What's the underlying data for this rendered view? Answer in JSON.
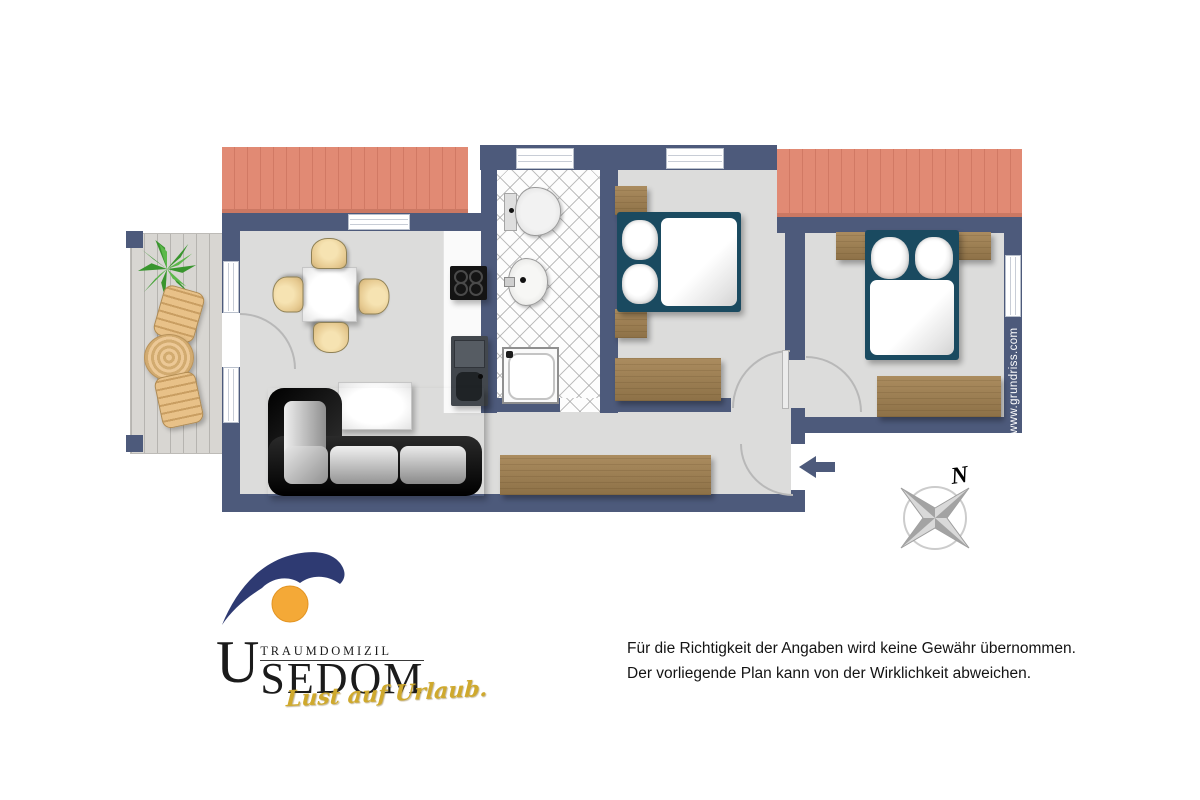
{
  "plan": {
    "watermark": "www.grundriss.com",
    "compass_label": "N"
  },
  "logo": {
    "brand_top": "TRAUMDOMIZIL",
    "brand_initial": "U",
    "brand_rest": "SEDOM",
    "tagline": "Lust auf Urlaub."
  },
  "disclaimer": {
    "line1": "Für die Richtigkeit der Angaben wird keine Gewähr übernommen.",
    "line2": "Der vorliegende Plan kann von der Wirklichkeit abweichen."
  },
  "colors": {
    "wall": "#4d5a7b",
    "roof": "#e18a74",
    "floor": "#dcdcdb",
    "terrace_deck": "#d8d6d2",
    "wood_furniture": "#a0845a",
    "bed_frame": "#1a4a60",
    "dining_chair": "#e7cb92",
    "logo_navy": "#2e3a72",
    "logo_sun": "#f4a937",
    "tagline_yellow": "#cfa92d"
  }
}
